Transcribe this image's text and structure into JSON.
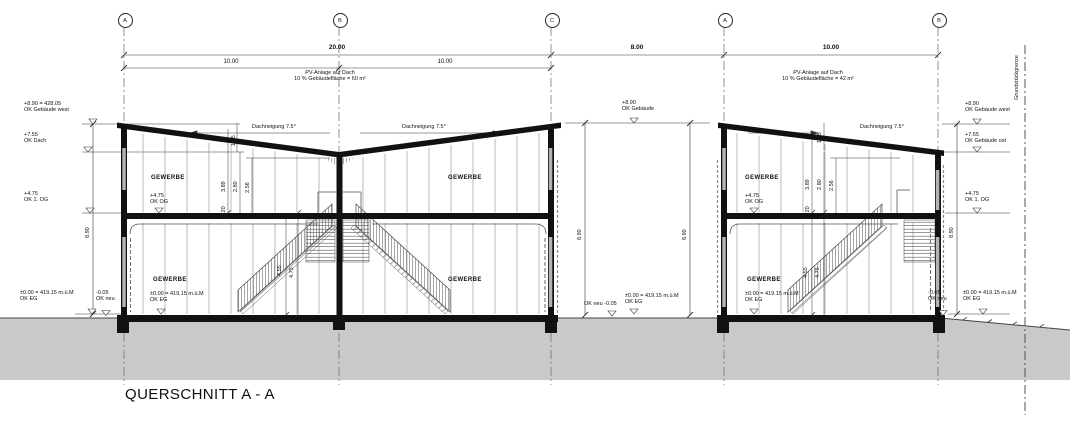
{
  "title": "QUERSCHNITT A - A",
  "drawing": {
    "type": "architectural cross section",
    "accent_colors": {
      "linework": "#111111",
      "ground": "#c9c9c9",
      "joints": "#9a9a9a"
    }
  },
  "grid": {
    "bubbles": [
      {
        "label": "A",
        "x": 124
      },
      {
        "label": "B",
        "x": 339
      },
      {
        "label": "C",
        "x": 551
      },
      {
        "label": "A",
        "x": 724
      },
      {
        "label": "B",
        "x": 938
      }
    ]
  },
  "annotations": [
    {
      "name": "dim-total-left",
      "s": "dim",
      "x": 337,
      "y": 45,
      "text": "20.00"
    },
    {
      "name": "dim-gap",
      "s": "dim",
      "x": 637,
      "y": 45,
      "text": "8.00"
    },
    {
      "name": "dim-right-bldg",
      "s": "dim",
      "x": 831,
      "y": 45,
      "text": "10.00"
    },
    {
      "name": "dim-bay-ab",
      "s": "dim2",
      "x": 231,
      "y": 59,
      "text": "10.00"
    },
    {
      "name": "dim-bay-bc",
      "s": "dim2",
      "x": 445,
      "y": 59,
      "text": "10.00"
    },
    {
      "name": "note-pv-left",
      "s": "ctr",
      "x": 330,
      "y": 70,
      "text": "PV-Anlage auf Dach\n10 % Gebäudefläche = 60 m²"
    },
    {
      "name": "note-pv-right",
      "s": "ctr",
      "x": 818,
      "y": 70,
      "text": "PV-Anlage auf Dach\n10 % Gebäudefläche = 42 m²"
    },
    {
      "name": "note-dachneigung-left1",
      "s": "",
      "x": 252,
      "y": 124,
      "text": "Dachneigung 7.5°"
    },
    {
      "name": "note-dachneigung-left2",
      "s": "",
      "x": 402,
      "y": 124,
      "text": "Dachneigung 7.5°"
    },
    {
      "name": "note-dachneigung-right",
      "s": "",
      "x": 860,
      "y": 124,
      "text": "Dachneigung 7.5°"
    },
    {
      "name": "level-ok-gebaeude-west-l",
      "s": "",
      "x": 24,
      "y": 101,
      "text": "+8.90 = 428.05\nOK Gebäude west"
    },
    {
      "name": "level-ok-dach-l",
      "s": "",
      "x": 24,
      "y": 132,
      "text": "+7.55\nOK Dach"
    },
    {
      "name": "level-ok-1og-l",
      "s": "",
      "x": 24,
      "y": 191,
      "text": "+4.75\nOK 1. OG"
    },
    {
      "name": "level-ok-eg-l",
      "s": "",
      "x": 20,
      "y": 290,
      "text": "±0.00 = 419.15 m.ü.M\nOK EG"
    },
    {
      "name": "level-ok-neu-l",
      "s": "",
      "x": 96,
      "y": 290,
      "text": "-0.05\nOK neu"
    },
    {
      "name": "level-ok-gebaeude-mid",
      "s": "",
      "x": 622,
      "y": 100,
      "text": "+8.90\nOK Gebäude"
    },
    {
      "name": "level-ok-neu-mid",
      "s": "",
      "x": 584,
      "y": 301,
      "text": "OK neu -0.05"
    },
    {
      "name": "level-ok-eg-mid",
      "s": "",
      "x": 625,
      "y": 293,
      "text": "±0.00 = 419.15 m.ü.M\nOK EG"
    },
    {
      "name": "level-ok-gebaeude-west-r",
      "s": "",
      "x": 965,
      "y": 101,
      "text": "+8.90\nOK Gebäude west"
    },
    {
      "name": "level-ok-gebaeude-ost-r",
      "s": "",
      "x": 965,
      "y": 132,
      "text": "+7.55\nOK Gebäude ost"
    },
    {
      "name": "level-ok-1og-r",
      "s": "",
      "x": 965,
      "y": 191,
      "text": "+4.75\nOK 1. OG"
    },
    {
      "name": "level-ok-eg-r",
      "s": "",
      "x": 963,
      "y": 290,
      "text": "±0.00 = 419.15 m.ü.M\nOK EG"
    },
    {
      "name": "level-ok-neu-r",
      "s": "",
      "x": 928,
      "y": 290,
      "text": "-0.05\nOK neu"
    },
    {
      "name": "room-gewerbe-og-left",
      "s": "room",
      "x": 151,
      "y": 175,
      "text": "GEWERBE"
    },
    {
      "name": "room-gewerbe-og-right",
      "s": "room",
      "x": 448,
      "y": 175,
      "text": "GEWERBE"
    },
    {
      "name": "room-gewerbe-eg-left",
      "s": "room",
      "x": 153,
      "y": 277,
      "text": "GEWERBE"
    },
    {
      "name": "room-gewerbe-eg-right",
      "s": "room",
      "x": 448,
      "y": 277,
      "text": "GEWERBE"
    },
    {
      "name": "level-ok-og-int-left",
      "s": "",
      "x": 150,
      "y": 193,
      "text": "+4.75\nOK OG"
    },
    {
      "name": "level-ok-eg-int-left",
      "s": "",
      "x": 150,
      "y": 291,
      "text": "±0.00 = 419.15 m.ü.M\nOK EG"
    },
    {
      "name": "room-gewerbe-og-b2",
      "s": "room",
      "x": 745,
      "y": 175,
      "text": "GEWERBE"
    },
    {
      "name": "room-gewerbe-eg-b2",
      "s": "room",
      "x": 747,
      "y": 277,
      "text": "GEWERBE"
    },
    {
      "name": "level-ok-og-int-b2",
      "s": "",
      "x": 745,
      "y": 193,
      "text": "+4.75\nOK OG"
    },
    {
      "name": "level-ok-eg-int-b2",
      "s": "",
      "x": 745,
      "y": 291,
      "text": "±0.00 = 419.15 m.ü.M\nOK EG"
    },
    {
      "name": "vdim-890-left",
      "s": "rot",
      "x": 85,
      "y": 238,
      "text": "8.90"
    },
    {
      "name": "vdim-890-mid1",
      "s": "rot",
      "x": 577,
      "y": 240,
      "text": "8.90"
    },
    {
      "name": "vdim-890-mid2",
      "s": "rot",
      "x": 682,
      "y": 240,
      "text": "8.90"
    },
    {
      "name": "vdim-890-right",
      "s": "rot",
      "x": 949,
      "y": 238,
      "text": "8.90"
    },
    {
      "name": "vdim-389-b1",
      "s": "rot",
      "x": 221,
      "y": 192,
      "text": "3.89"
    },
    {
      "name": "vdim-280-b1",
      "s": "rot",
      "x": 233,
      "y": 192,
      "text": "2.80"
    },
    {
      "name": "vdim-256-b1",
      "s": "rot",
      "x": 245,
      "y": 193,
      "text": "2.56"
    },
    {
      "name": "vdim-020-b1",
      "s": "rot",
      "x": 221,
      "y": 214,
      "text": ".20"
    },
    {
      "name": "vdim-135-b1",
      "s": "rot",
      "x": 231,
      "y": 146,
      "text": "1.35"
    },
    {
      "name": "vdim-455-b1",
      "s": "rot",
      "x": 277,
      "y": 276,
      "text": "4.55"
    },
    {
      "name": "vdim-475-b1",
      "s": "rot",
      "x": 289,
      "y": 278,
      "text": "4.75"
    },
    {
      "name": "vdim-389-b2",
      "s": "rot",
      "x": 805,
      "y": 190,
      "text": "3.89"
    },
    {
      "name": "vdim-280-b2",
      "s": "rot",
      "x": 817,
      "y": 190,
      "text": "2.80"
    },
    {
      "name": "vdim-256-b2",
      "s": "rot",
      "x": 829,
      "y": 191,
      "text": "2.56"
    },
    {
      "name": "vdim-020-b2",
      "s": "rot",
      "x": 805,
      "y": 214,
      "text": ".20"
    },
    {
      "name": "vdim-135-b2",
      "s": "rot",
      "x": 817,
      "y": 143,
      "text": "1.35"
    },
    {
      "name": "vdim-455-b2",
      "s": "rot",
      "x": 803,
      "y": 278,
      "text": "4.55"
    },
    {
      "name": "vdim-475-b2",
      "s": "rot",
      "x": 815,
      "y": 278,
      "text": "4.75"
    },
    {
      "name": "property-line-label",
      "s": "rot",
      "x": 1014,
      "y": 100,
      "text": "Grundstückgrenze"
    }
  ]
}
